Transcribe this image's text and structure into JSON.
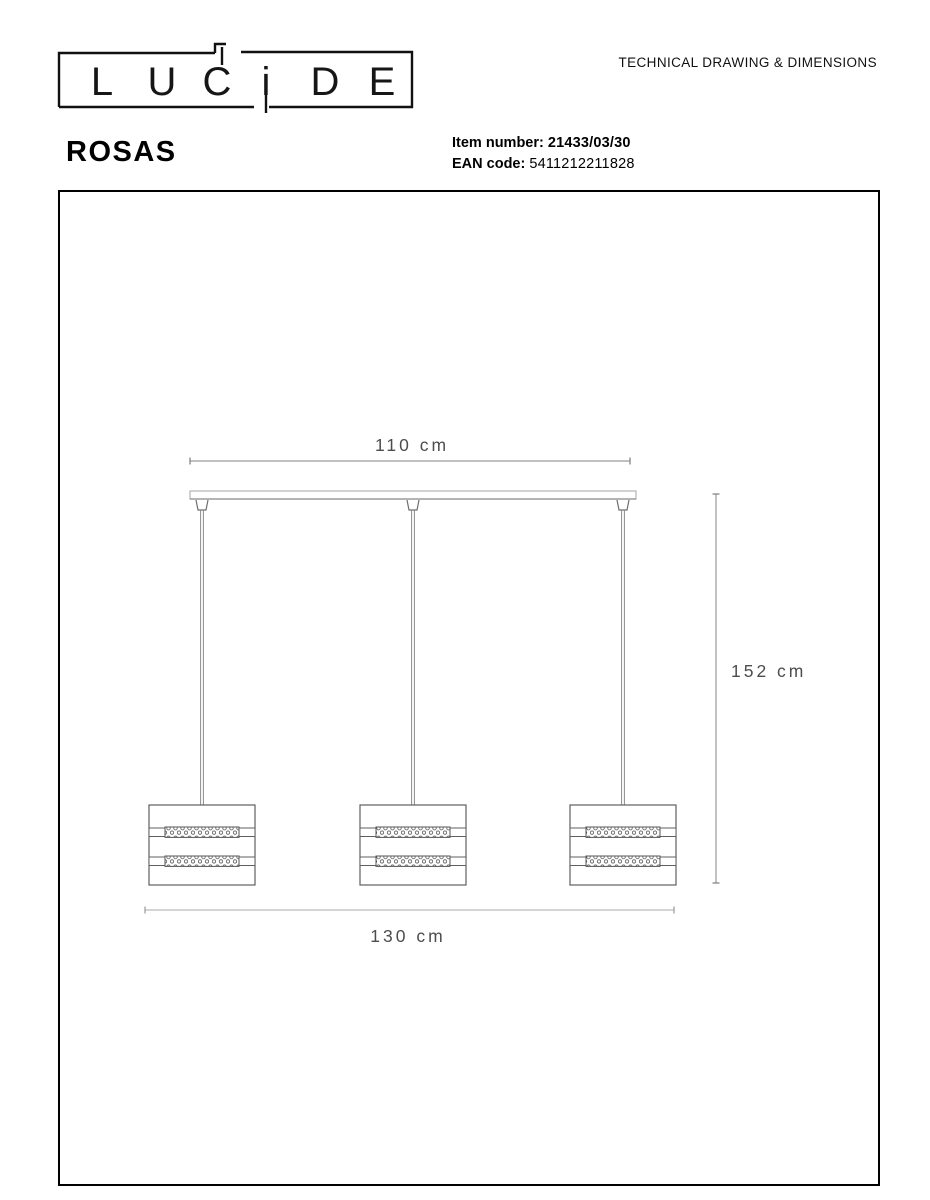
{
  "header": {
    "logo_letters": [
      "L",
      "U",
      "C",
      "i",
      "D",
      "E"
    ],
    "doc_title": "TECHNICAL DRAWING & DIMENSIONS",
    "product_name": "ROSAS",
    "item_number_label": "Item number:",
    "item_number_value": "21433/03/30",
    "ean_label": "EAN code:",
    "ean_value": "5411212211828"
  },
  "drawing": {
    "dim_width_top": "110 cm",
    "dim_height": "152 cm",
    "dim_width_bottom": "130 cm"
  },
  "colors": {
    "ink": "#1a1a1a",
    "frame": "#000000",
    "shade_line": "#5f5f5f",
    "cord_line": "#8a8a8a",
    "canopy_line": "#b3b3b3",
    "dim_line": "#9a9a9a",
    "dim_line_light": "#c6c6c6",
    "dim_text": "#4d4d4d"
  }
}
